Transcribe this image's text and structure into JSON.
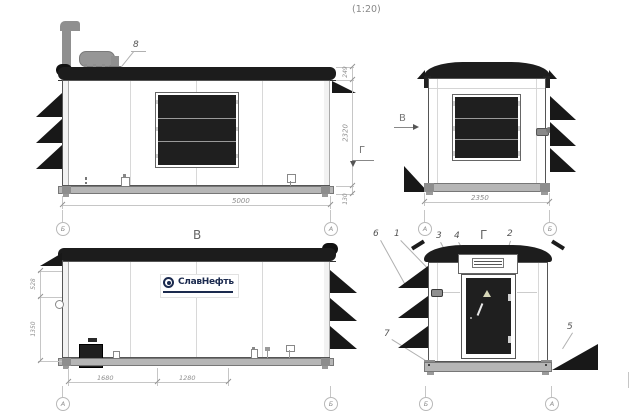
{
  "scale_note": "(1:20)",
  "markers": {
    "view_b_arrow": "В",
    "view_g_arrow": "Г"
  },
  "side_view_top": {
    "exhaust_callout": "8",
    "dim_width": "5000",
    "dim_roof": "249",
    "dim_wall": "2320",
    "dim_base": "130",
    "grid_left": "Б",
    "grid_right": "А"
  },
  "end_view_top": {
    "dim_width": "2350",
    "grid_left": "А",
    "grid_right": "Б"
  },
  "side_view_b": {
    "title": "В",
    "logo": "СлавНефть",
    "dim_upper": "528",
    "dim_lower": "1350",
    "dim_left": "1680",
    "dim_right": "1280",
    "grid_left": "А",
    "grid_right": "Б"
  },
  "end_view_g": {
    "title": "Г",
    "c1": "1",
    "c2": "2",
    "c3": "3",
    "c4": "4",
    "c5": "5",
    "c6": "6",
    "c7": "7",
    "grid_left": "Б",
    "grid_right": "А"
  },
  "icons": {
    "warning_triangle": "door-warning-triangle",
    "logo_emblem": "slavneft-emblem"
  }
}
